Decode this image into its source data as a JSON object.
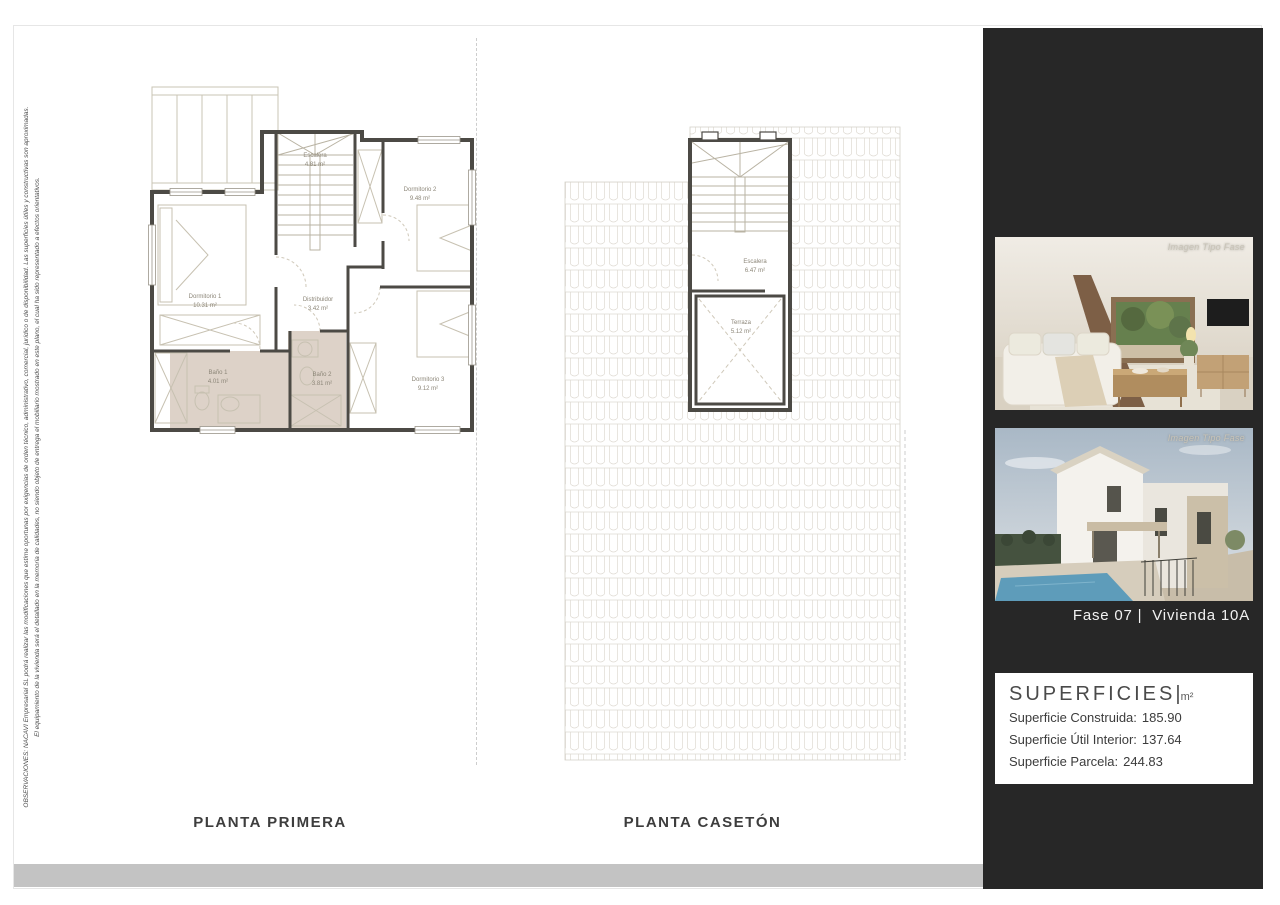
{
  "page": {
    "disclaimer_line1": "OBSERVACIONES: NACAVI Empresarial SL podrá realizar las modificaciones que estime oportunas por exigencias de orden técnico, administrativo, comercial, jurídico o de disponibilidad. Las superficies útiles y constructivas son aproximadas.",
    "disclaimer_line2": "El equipamiento de la vivienda será el detallado en la memoria de calidades, no siendo objeto de entrega el mobiliario mostrado en este plano, el  cual ha sido representado a efectos orientativos."
  },
  "plans": {
    "primera": {
      "title": "PLANTA PRIMERA",
      "rooms": [
        {
          "name": "Dormitorio 1",
          "area": "10.31 m²"
        },
        {
          "name": "Dormitorio 2",
          "area": "9.48 m²"
        },
        {
          "name": "Dormitorio 3",
          "area": "9.12 m²"
        },
        {
          "name": "Distribuidor",
          "area": "3.42 m²"
        },
        {
          "name": "Escalera",
          "area": "4.81 m²"
        },
        {
          "name": "Baño 1",
          "area": "4.01 m²"
        },
        {
          "name": "Baño 2",
          "area": "3.81 m²"
        }
      ]
    },
    "caseton": {
      "title": "PLANTA CASETÓN",
      "rooms": [
        {
          "name": "Escalera",
          "area": "6.47 m²"
        },
        {
          "name": "Terraza",
          "area": "5.12 m²"
        }
      ]
    }
  },
  "sidebar": {
    "photo1_caption": "Imagen Tipo Fase",
    "photo2_caption": "Imagen Tipo Fase",
    "unit_label": "Fase 07 |  Vivienda 10A",
    "surfaces": {
      "title": "SUPERFICIES",
      "separator": "|",
      "unit": "m²",
      "rows": [
        {
          "label": "Superficie Construida:",
          "value": "185.90"
        },
        {
          "label": "Superficie Útil Interior:",
          "value": "137.64"
        },
        {
          "label": "Superficie Parcela:",
          "value": "244.83"
        }
      ]
    }
  },
  "colors": {
    "sidebar_bg": "#272727",
    "bath_floor": "#ddd2c8",
    "wall": "#4c4a45",
    "footer_strip": "#c3c3c3"
  }
}
